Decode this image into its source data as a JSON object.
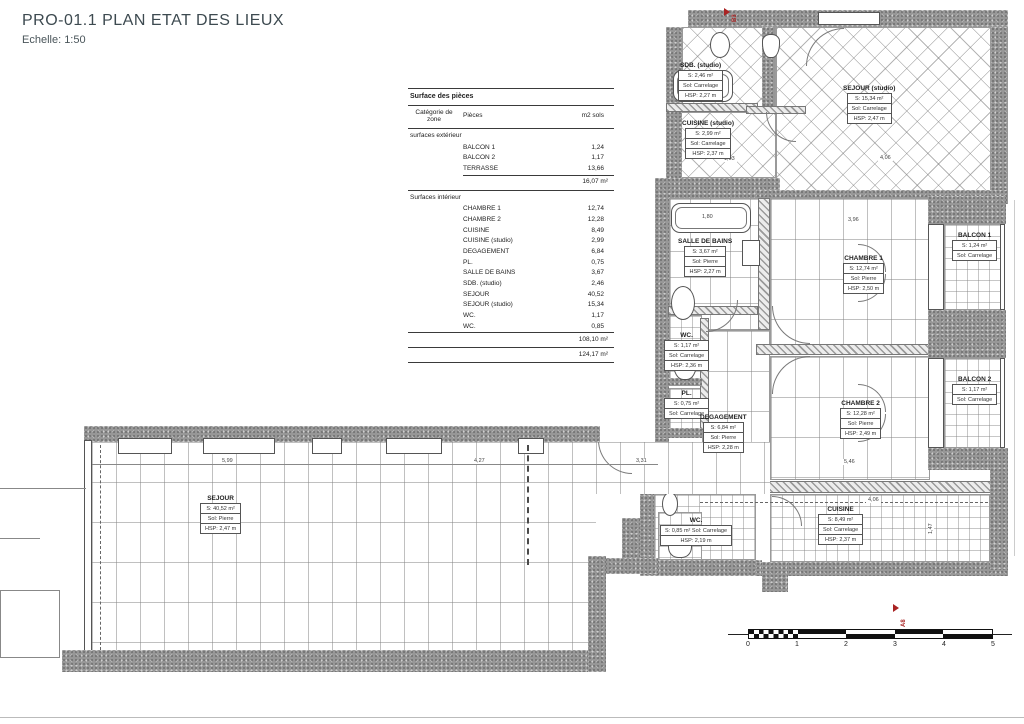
{
  "title": {
    "main": "PRO-01.1 PLAN ETAT DES LIEUX",
    "scale_label": "Echelle: 1:50"
  },
  "table": {
    "title": "Surface des pièces",
    "col_category": "Catégorie de zone",
    "col_pieces": "Pièces",
    "col_m2": "m2 sols",
    "section_ext": "surfaces extérieur",
    "ext_rows": [
      [
        "BALCON 1",
        "1,24"
      ],
      [
        "BALCON 2",
        "1,17"
      ],
      [
        "TERRASSE",
        "13,66"
      ]
    ],
    "ext_subtotal": "16,07 m²",
    "section_int": "Surfaces intérieur",
    "int_rows": [
      [
        "CHAMBRE 1",
        "12,74"
      ],
      [
        "CHAMBRE 2",
        "12,28"
      ],
      [
        "CUISINE",
        "8,49"
      ],
      [
        "CUISINE (studio)",
        "2,99"
      ],
      [
        "DEGAGEMENT",
        "6,84"
      ],
      [
        "PL.",
        "0,75"
      ],
      [
        "SALLE DE BAINS",
        "3,67"
      ],
      [
        "SDB. (studio)",
        "2,46"
      ],
      [
        "SEJOUR",
        "40,52"
      ],
      [
        "SEJOUR (studio)",
        "15,34"
      ],
      [
        "WC.",
        "1,17"
      ],
      [
        "WC.",
        "0,85"
      ]
    ],
    "int_subtotal": "108,10 m²",
    "total": "124,17 m²"
  },
  "rooms": {
    "sdb_studio": {
      "name": "SDB. (studio)",
      "area": "S: 2,46 m²",
      "floor": "Sol: Carrelage",
      "hsp": "HSP: 2,27 m"
    },
    "cuisine_studio": {
      "name": "CUISINE (studio)",
      "area": "S: 2,99 m²",
      "floor": "Sol: Carrelage",
      "hsp": "HSP: 2,37 m"
    },
    "sejour_studio": {
      "name": "SEJOUR (studio)",
      "area": "S: 15,34 m²",
      "floor": "Sol: Carrelage",
      "hsp": "HSP: 2,47 m"
    },
    "salle_de_bains": {
      "name": "SALLE DE BAINS",
      "area": "S: 3,67 m²",
      "floor": "Sol: Pierre",
      "hsp": "HSP: 2,27 m"
    },
    "chambre1": {
      "name": "CHAMBRE 1",
      "area": "S: 12,74 m²",
      "floor": "Sol: Pierre",
      "hsp": "HSP: 2,50 m"
    },
    "balcon1": {
      "name": "BALCON 1",
      "area": "S: 1,24 m²",
      "floor": "Sol: Carrelage"
    },
    "wc1": {
      "name": "WC.",
      "area": "S: 1,17 m²",
      "floor": "Sol: Carrelage",
      "hsp": "HSP: 2,36 m"
    },
    "pl": {
      "name": "PL.",
      "area": "S: 0,75 m²",
      "floor": "Sol: Carrelage"
    },
    "degagement": {
      "name": "DEGAGEMENT",
      "area": "S: 6,84 m²",
      "floor": "Sol: Pierre",
      "hsp": "HSP: 2,28 m"
    },
    "chambre2": {
      "name": "CHAMBRE 2",
      "area": "S: 12,28 m²",
      "floor": "Sol: Pierre",
      "hsp": "HSP: 2,49 m"
    },
    "balcon2": {
      "name": "BALCON 2",
      "area": "S: 1,17 m²",
      "floor": "Sol: Carrelage"
    },
    "cuisine": {
      "name": "CUISINE",
      "area": "S: 8,49 m²",
      "floor": "Sol: Carrelage",
      "hsp": "HSP: 2,37 m"
    },
    "wc2": {
      "name": "WC.",
      "area": "S: 0,85 m² Sol: Carrelage",
      "hsp": "HSP: 2,19 m"
    },
    "sejour": {
      "name": "SEJOUR",
      "area": "S: 40,52 m²",
      "floor": "Sol: Pierre",
      "hsp": "HSP: 2,47 m"
    },
    "terrasse": {
      "name": "TERRASSE",
      "area": "S: 13,66 m²",
      "floor": "Sol: Carrelage"
    }
  },
  "dims": [
    {
      "t": "5,99"
    },
    {
      "t": "4,27"
    },
    {
      "t": "3,31"
    },
    {
      "t": "3,96"
    },
    {
      "t": "1,80"
    },
    {
      "t": "1,03"
    },
    {
      "t": "4,06"
    },
    {
      "t": "4,06"
    },
    {
      "t": "5,46"
    },
    {
      "t": "1,47"
    }
  ],
  "markers": {
    "b3": "B3",
    "a8": "A8"
  },
  "scalebar": {
    "ticks": [
      "0",
      "1",
      "2",
      "3",
      "4",
      "5"
    ]
  }
}
